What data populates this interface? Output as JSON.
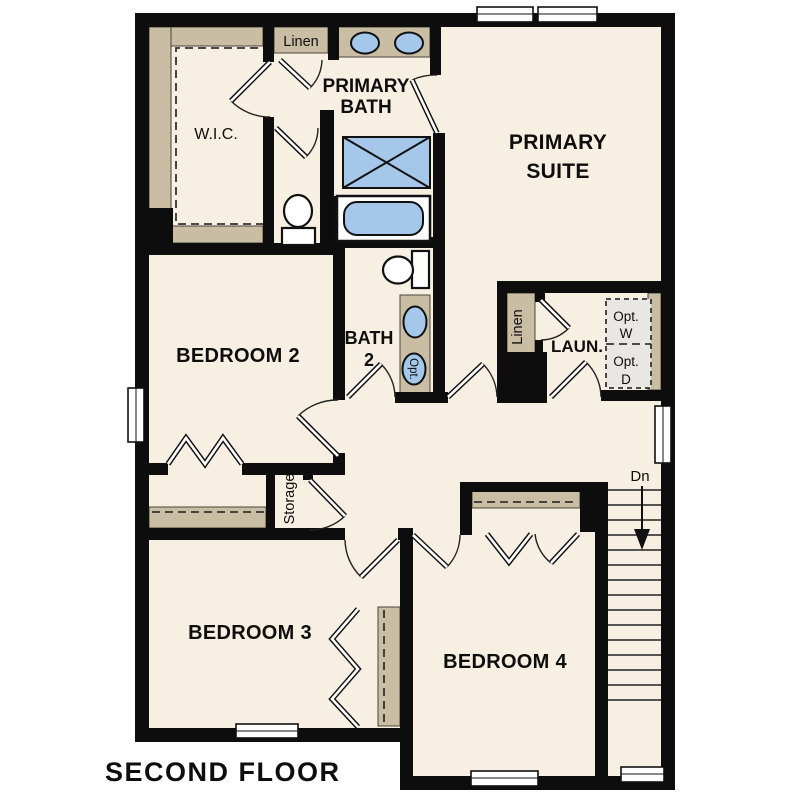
{
  "floor_plan": {
    "title": "SECOND FLOOR",
    "rooms": {
      "primary_suite": {
        "line1": "PRIMARY",
        "line2": "SUITE"
      },
      "primary_bath": {
        "line1": "PRIMARY",
        "line2": "BATH"
      },
      "wic": "W.I.C.",
      "bedroom2": "BEDROOM 2",
      "bath2": {
        "line1": "BATH",
        "line2": "2"
      },
      "laundry": "LAUN.",
      "bedroom3": "BEDROOM 3",
      "bedroom4": "BEDROOM 4"
    },
    "closets": {
      "linen_hall": "Linen",
      "linen_laundry": "Linen",
      "storage": "Storage"
    },
    "options": {
      "washer": {
        "line1": "Opt.",
        "line2": "W"
      },
      "dryer": {
        "line1": "Opt.",
        "line2": "D"
      },
      "sink": "Opt."
    },
    "stairs": {
      "direction_label": "Dn"
    },
    "colors": {
      "wall": "#0d0d0d",
      "floor": "#f6efe2",
      "casework_tan": "#c9bda4",
      "fixture_blue": "#a5c7e9",
      "optional_gray": "#e8e7e4",
      "background": "#ffffff"
    }
  }
}
